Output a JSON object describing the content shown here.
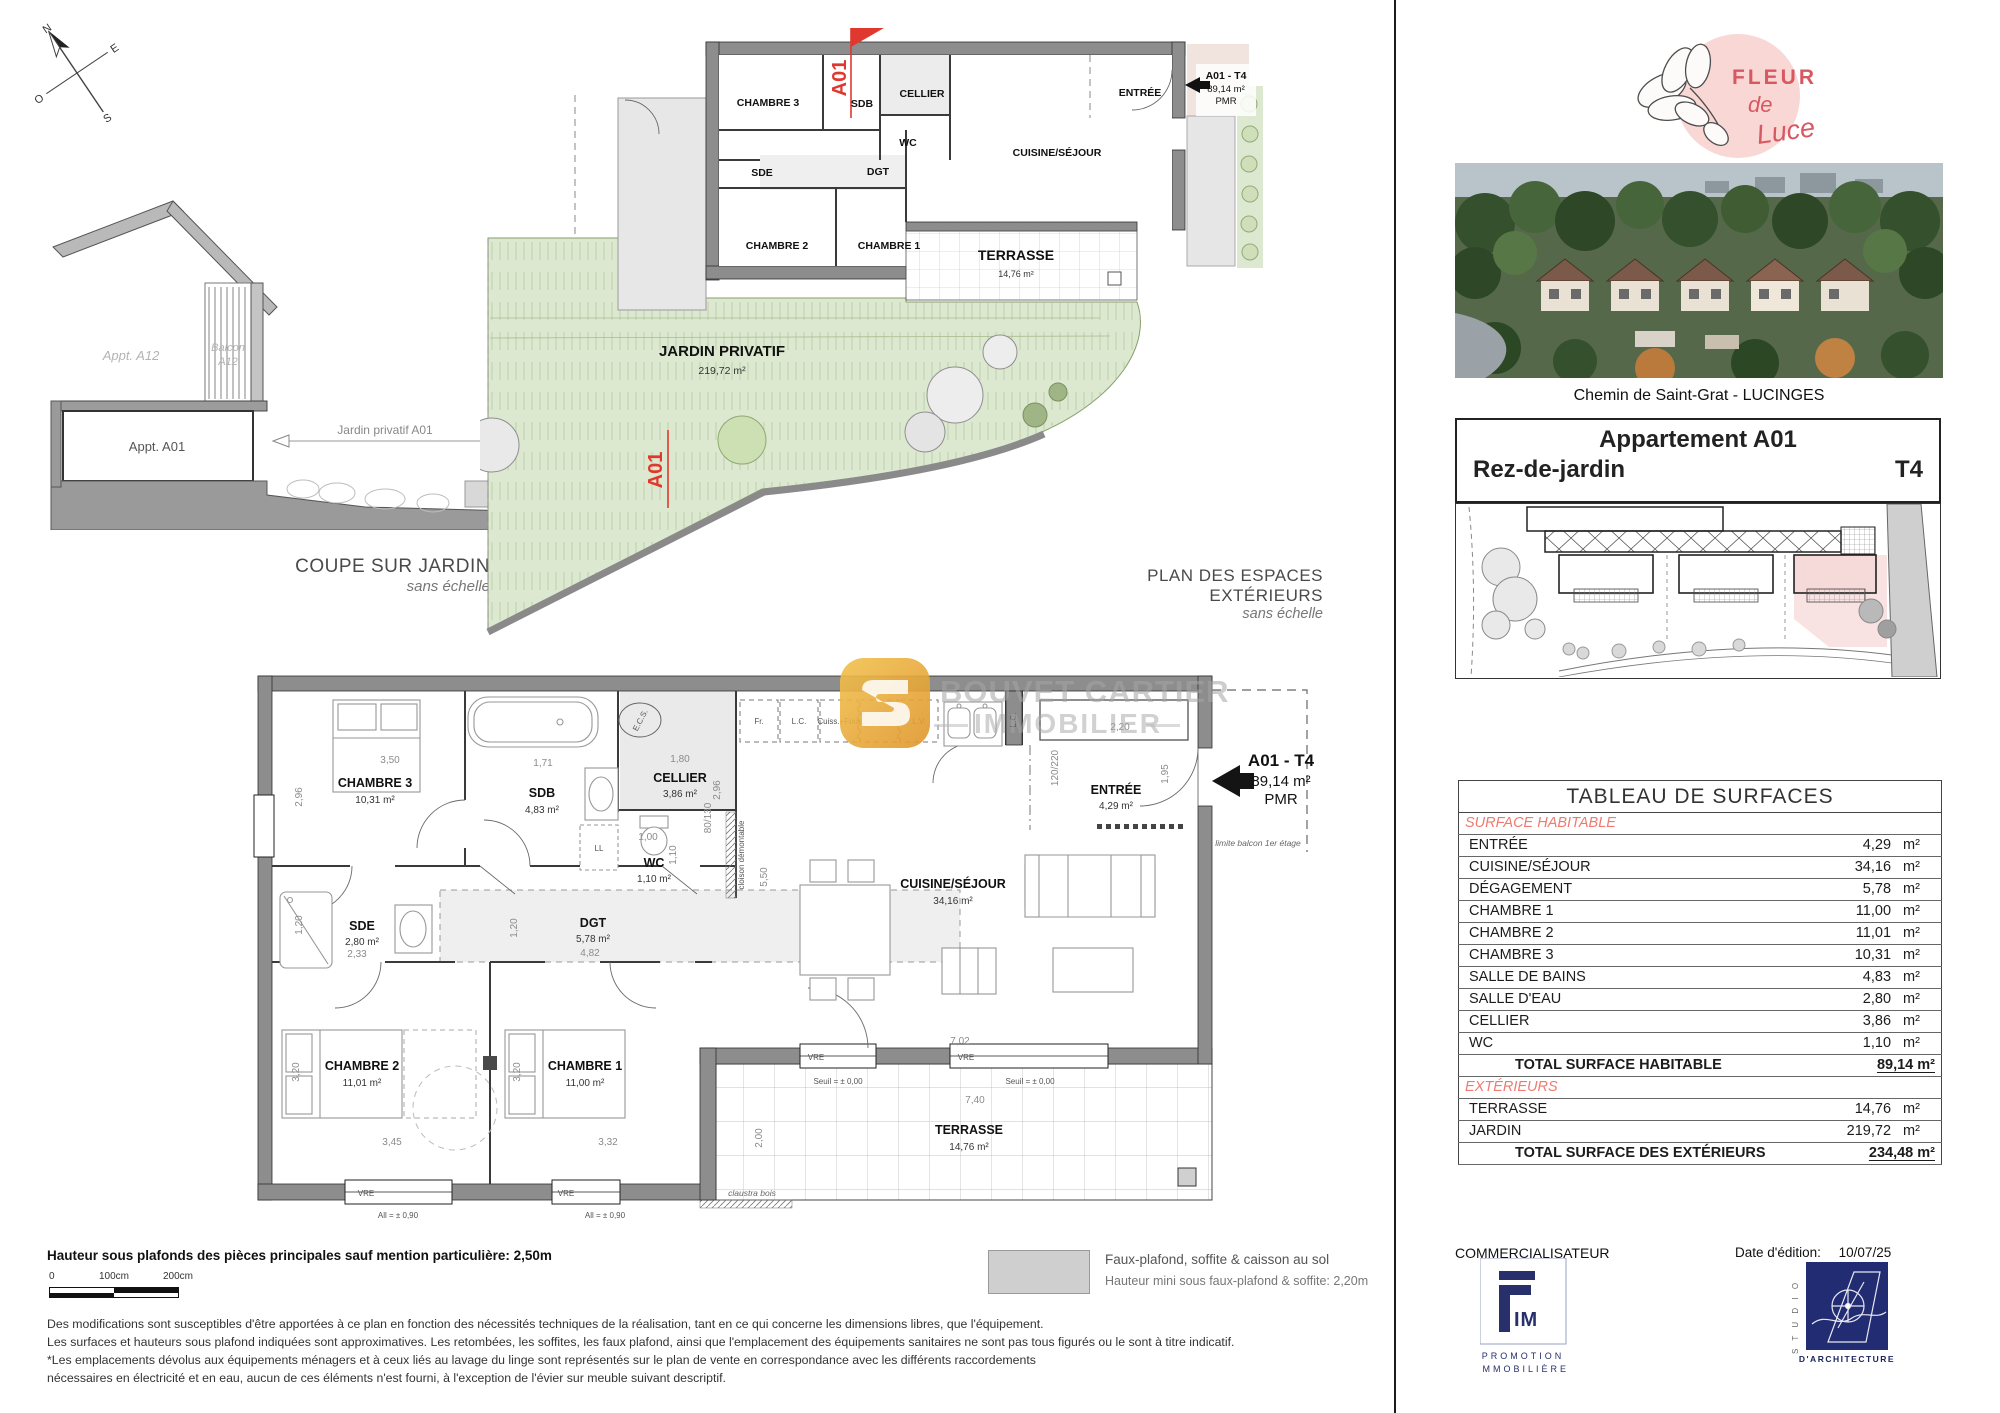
{
  "compass": {
    "n": "N",
    "e": "E",
    "s": "S",
    "o": "O"
  },
  "coupe": {
    "caption_title": "COUPE SUR JARDIN",
    "caption_sub": "sans échelle",
    "appt_a12": "Appt. A12",
    "balcon_l1": "Balcon",
    "balcon_l2": "A12",
    "appt_a01": "Appt. A01",
    "jardin_dim": "Jardin privatif A01"
  },
  "ext": {
    "caption_title": "PLAN DES ESPACES EXTÉRIEURS",
    "caption_sub": "sans échelle",
    "jardin_name": "JARDIN PRIVATIF",
    "jardin_area": "219,72 m²",
    "marker": "A01"
  },
  "plan": {
    "rooms": {
      "ch3": {
        "n": "CHAMBRE 3",
        "a": "10,31 m²"
      },
      "sdb": {
        "n": "SDB",
        "a": "4,83 m²"
      },
      "cellier": {
        "n": "CELLIER",
        "a": "3,86 m²"
      },
      "wc": {
        "n": "WC",
        "a": "1,10 m²"
      },
      "sde": {
        "n": "SDE",
        "a": "2,80 m²"
      },
      "dgt": {
        "n": "DGT",
        "a": "5,78 m²"
      },
      "ch2": {
        "n": "CHAMBRE 2",
        "a": "11,01 m²"
      },
      "ch1": {
        "n": "CHAMBRE 1",
        "a": "11,00 m²"
      },
      "cuisine": {
        "n": "CUISINE/SÉJOUR",
        "a": "34,16 m²"
      },
      "entree": {
        "n": "ENTRÉE",
        "a": "4,29 m²"
      },
      "terrasse": {
        "n": "TERRASSE",
        "a": "14,76 m²"
      }
    },
    "dims": {
      "ch3_w": "3,50",
      "ch3_h": "2,96",
      "sdb_w": "1,71",
      "cel_w": "1,80",
      "cel_h": "2,96",
      "niche": "80/130",
      "wc_w": "1,00",
      "wc_h": "1,10",
      "dgt_w": "4,82",
      "dgt_h": "1,20",
      "sde_w": "2,33",
      "sde_h": "1,20",
      "ch2_w": "3,45",
      "ch2_h": "3,20",
      "ch1_w": "3,32",
      "ch1_h": "3,20",
      "sej_h": "5,50",
      "sej_w": "7,02",
      "ter_w": "7,40",
      "ter_h": "2,00",
      "ent_w": "2,20",
      "ent_h": "1,95",
      "porte": "120/220"
    },
    "kitchen": [
      "Fr.",
      "L.C.",
      "Cuiss.+Four",
      "L.C.",
      "L.V."
    ],
    "kitchen_lc_vert": "L.C.",
    "ann": {
      "ecs": "E.C.S.",
      "ll": "LL",
      "vre": "VRE",
      "allege": "All = ± 0,90",
      "seuil": "Seuil = ± 0,00",
      "claustra": "claustra bois",
      "cloison": "cloison démontable",
      "limite": "limite balcon 1er étage"
    },
    "unit": {
      "label": "A01 - T4",
      "area": "89,14 m²",
      "pmr": "PMR"
    }
  },
  "watermark": {
    "line1": "BOUVET CARTIER",
    "line2": "IMMOBILIER"
  },
  "notes": {
    "height": "Hauteur sous plafonds des pièces principales sauf mention particulière: 2,50m",
    "scale0": "0",
    "scale1": "100cm",
    "scale2": "200cm",
    "line1": "Des modifications sont susceptibles d'être apportées à ce plan en fonction des nécessités techniques de la réalisation, tant en ce qui concerne les dimensions libres, que l'équipement.",
    "line2": "Les surfaces et hauteurs sous plafond indiquées sont approximatives. Les retombées, les soffites, les faux plafond, ainsi que l'emplacement des équipements sanitaires ne sont pas tous figurés ou le sont à titre indicatif.",
    "line3": "*Les emplacements dévolus aux équipements ménagers et à ceux liés au lavage du linge sont représentés sur le plan de vente en correspondance avec les différents raccordements",
    "line4": "nécessaires en électricité et en eau, aucun de ces éléments n'est fourni, à l'exception de l'évier sur meuble suivant descriptif."
  },
  "legend": {
    "line1": "Faux-plafond, soffite & caisson au sol",
    "line2": "Hauteur mini sous faux-plafond & soffite: 2,20m"
  },
  "sidebar": {
    "logo_fleur": "FLEUR",
    "logo_de": "de",
    "logo_luce": "Luce",
    "address": "Chemin de Saint-Grat - LUCINGES",
    "apt_title": "Appartement A01",
    "level": "Rez-de-jardin",
    "type": "T4"
  },
  "surfaces": {
    "title": "TABLEAU DE SURFACES",
    "unit": "m²",
    "sec1": "SURFACE HABITABLE",
    "sec2": "EXTÉRIEURS",
    "rows": [
      {
        "l": "ENTRÉE",
        "v": "4,29"
      },
      {
        "l": "CUISINE/SÉJOUR",
        "v": "34,16"
      },
      {
        "l": "DÉGAGEMENT",
        "v": "5,78"
      },
      {
        "l": "CHAMBRE 1",
        "v": "11,00"
      },
      {
        "l": "CHAMBRE 2",
        "v": "11,01"
      },
      {
        "l": "CHAMBRE 3",
        "v": "10,31"
      },
      {
        "l": "SALLE DE BAINS",
        "v": "4,83"
      },
      {
        "l": "SALLE D'EAU",
        "v": "2,80"
      },
      {
        "l": "CELLIER",
        "v": "3,86"
      },
      {
        "l": "WC",
        "v": "1,10"
      }
    ],
    "total1": {
      "l": "TOTAL SURFACE HABITABLE",
      "v": "89,14 m²"
    },
    "ext_rows": [
      {
        "l": "TERRASSE",
        "v": "14,76"
      },
      {
        "l": "JARDIN",
        "v": "219,72"
      }
    ],
    "total2": {
      "l": "TOTAL SURFACE DES EXTÉRIEURS",
      "v": "234,48 m²"
    }
  },
  "footer": {
    "comm": "COMMERCIALISATEUR",
    "date_label": "Date d'édition:",
    "date": "10/07/25",
    "fim_im": "IM",
    "fim_l1": "PROMOTION",
    "fim_l2": "IMMOBILIÈRE",
    "studio_vert": "S T U D I O",
    "studio_sub": "D'ARCHITECTURE"
  }
}
